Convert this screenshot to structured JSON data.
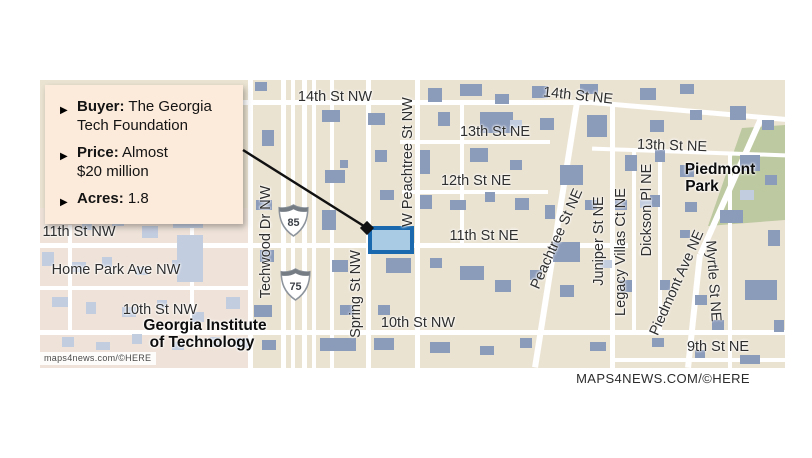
{
  "page": {
    "bg": "#ffffff"
  },
  "callout": {
    "bg": "#fceada",
    "bullet_icon": "▶",
    "items": [
      {
        "label": "Buyer:",
        "lines": [
          "The Georgia",
          "Tech Foundation"
        ]
      },
      {
        "label": "Price:",
        "lines": [
          "Almost",
          "$20 million"
        ]
      },
      {
        "label": "Acres:",
        "lines": [
          "1.8"
        ]
      }
    ]
  },
  "attribution_footer": "MAPS4NEWS.COM/©HERE",
  "map": {
    "colors": {
      "background": "#ebe3d2",
      "campus": "#efe3d9",
      "park": "#bdc9a0",
      "road": "#ffffff",
      "building_dark": "#8b9bba",
      "building_light": "#c2cddf",
      "parcel_fill": "#a9cbe3",
      "parcel_border": "#1a69ae",
      "connector": "#111111"
    },
    "attribution": "maps4news.com/©HERE",
    "shields": [
      {
        "num": "85",
        "x": 238,
        "y": 124
      },
      {
        "num": "75",
        "x": 240,
        "y": 188
      }
    ],
    "parcel": {
      "x": 328,
      "y": 146,
      "w": 46,
      "h": 28
    },
    "connector": {
      "x1": 243,
      "y1": 150,
      "x2": 367,
      "y2": 228
    },
    "roads": [
      {
        "x": 200,
        "y": 20,
        "w": 350,
        "h": 5,
        "r": 0
      },
      {
        "x": 539,
        "y": 28,
        "w": 208,
        "h": 5,
        "r": 5
      },
      {
        "x": 360,
        "y": 60,
        "w": 150,
        "h": 4,
        "r": 0
      },
      {
        "x": 552,
        "y": 70,
        "w": 195,
        "h": 4,
        "r": 2
      },
      {
        "x": 362,
        "y": 110,
        "w": 146,
        "h": 4,
        "r": 0
      },
      {
        "x": 0,
        "y": 163,
        "w": 588,
        "h": 5,
        "r": 0
      },
      {
        "x": 0,
        "y": 206,
        "w": 212,
        "h": 4,
        "r": 0
      },
      {
        "x": 0,
        "y": 250,
        "w": 745,
        "h": 5,
        "r": 0
      },
      {
        "x": 575,
        "y": 278,
        "w": 170,
        "h": 4,
        "r": 0
      },
      {
        "x": 208,
        "y": 0,
        "w": 5,
        "h": 288,
        "r": 0
      },
      {
        "x": 241,
        "y": 0,
        "w": 5,
        "h": 288,
        "r": 0
      },
      {
        "x": 251,
        "y": 0,
        "w": 4,
        "h": 288,
        "r": 0
      },
      {
        "x": 262,
        "y": 0,
        "w": 5,
        "h": 288,
        "r": 0
      },
      {
        "x": 272,
        "y": 0,
        "w": 4,
        "h": 288,
        "r": 0
      },
      {
        "x": 290,
        "y": 0,
        "w": 4,
        "h": 288,
        "r": 0
      },
      {
        "x": 326,
        "y": 0,
        "w": 5,
        "h": 288,
        "r": 0
      },
      {
        "x": 375,
        "y": 0,
        "w": 5,
        "h": 288,
        "r": 0
      },
      {
        "x": 420,
        "y": 20,
        "w": 4,
        "h": 145,
        "r": 0
      },
      {
        "x": 570,
        "y": 22,
        "w": 5,
        "h": 266,
        "r": 0
      },
      {
        "x": 592,
        "y": 70,
        "w": 4,
        "h": 182,
        "r": 0
      },
      {
        "x": 618,
        "y": 70,
        "w": 4,
        "h": 180,
        "r": 0
      },
      {
        "x": 688,
        "y": 72,
        "w": 4,
        "h": 216,
        "r": 0
      },
      {
        "x": 513,
        "y": 21,
        "w": 6,
        "h": 268,
        "r": 9
      },
      {
        "x": 688,
        "y": 31,
        "w": 6,
        "h": 150,
        "r": 24
      },
      {
        "x": 651,
        "y": 174,
        "w": 6,
        "h": 114,
        "r": 6
      },
      {
        "x": 28,
        "y": 145,
        "w": 4,
        "h": 107,
        "r": 0
      },
      {
        "x": 150,
        "y": 125,
        "w": 4,
        "h": 127,
        "r": 0
      }
    ],
    "buildings": [
      [
        215,
        2,
        12,
        9,
        "d"
      ],
      [
        222,
        50,
        12,
        16,
        "d"
      ],
      [
        216,
        120,
        16,
        10,
        "d"
      ],
      [
        220,
        170,
        14,
        12,
        "d"
      ],
      [
        214,
        225,
        18,
        12,
        "d"
      ],
      [
        222,
        260,
        14,
        10,
        "d"
      ],
      [
        282,
        30,
        18,
        12,
        "d"
      ],
      [
        285,
        90,
        20,
        13,
        "d"
      ],
      [
        300,
        80,
        8,
        8,
        "d"
      ],
      [
        282,
        130,
        14,
        20,
        "d"
      ],
      [
        292,
        180,
        16,
        12,
        "d"
      ],
      [
        300,
        225,
        14,
        10,
        "d"
      ],
      [
        280,
        258,
        36,
        13,
        "d"
      ],
      [
        328,
        33,
        17,
        12,
        "d"
      ],
      [
        335,
        70,
        12,
        12,
        "d"
      ],
      [
        340,
        110,
        14,
        10,
        "d"
      ],
      [
        346,
        178,
        25,
        15,
        "d"
      ],
      [
        338,
        225,
        12,
        10,
        "d"
      ],
      [
        334,
        258,
        20,
        12,
        "d"
      ],
      [
        388,
        8,
        14,
        14,
        "d"
      ],
      [
        420,
        4,
        22,
        12,
        "d"
      ],
      [
        455,
        14,
        14,
        10,
        "d"
      ],
      [
        492,
        6,
        16,
        12,
        "d"
      ],
      [
        440,
        32,
        33,
        21,
        "d"
      ],
      [
        398,
        32,
        12,
        14,
        "d"
      ],
      [
        500,
        38,
        14,
        12,
        "d"
      ],
      [
        380,
        70,
        10,
        24,
        "d"
      ],
      [
        430,
        68,
        18,
        14,
        "d"
      ],
      [
        470,
        80,
        12,
        10,
        "d"
      ],
      [
        380,
        115,
        12,
        14,
        "d"
      ],
      [
        410,
        120,
        16,
        10,
        "d"
      ],
      [
        445,
        112,
        10,
        10,
        "d"
      ],
      [
        475,
        118,
        14,
        12,
        "d"
      ],
      [
        505,
        125,
        10,
        14,
        "d"
      ],
      [
        390,
        178,
        12,
        10,
        "d"
      ],
      [
        420,
        186,
        24,
        14,
        "d"
      ],
      [
        455,
        200,
        16,
        12,
        "d"
      ],
      [
        490,
        190,
        12,
        10,
        "d"
      ],
      [
        390,
        262,
        20,
        11,
        "d"
      ],
      [
        440,
        266,
        14,
        9,
        "d"
      ],
      [
        480,
        258,
        12,
        10,
        "d"
      ],
      [
        540,
        4,
        18,
        10,
        "d"
      ],
      [
        547,
        35,
        20,
        22,
        "d"
      ],
      [
        520,
        85,
        23,
        20,
        "d"
      ],
      [
        513,
        162,
        27,
        20,
        "d"
      ],
      [
        520,
        205,
        14,
        12,
        "d"
      ],
      [
        545,
        120,
        12,
        10,
        "d"
      ],
      [
        550,
        262,
        16,
        9,
        "d"
      ],
      [
        600,
        8,
        16,
        12,
        "d"
      ],
      [
        640,
        4,
        14,
        10,
        "d"
      ],
      [
        610,
        40,
        14,
        12,
        "d"
      ],
      [
        650,
        30,
        12,
        10,
        "d"
      ],
      [
        585,
        75,
        12,
        16,
        "d"
      ],
      [
        615,
        70,
        10,
        12,
        "d"
      ],
      [
        640,
        85,
        14,
        12,
        "d"
      ],
      [
        575,
        120,
        12,
        10,
        "d"
      ],
      [
        610,
        115,
        10,
        12,
        "d"
      ],
      [
        645,
        122,
        12,
        10,
        "d"
      ],
      [
        640,
        150,
        10,
        8,
        "d"
      ],
      [
        580,
        200,
        12,
        12,
        "d"
      ],
      [
        620,
        200,
        10,
        10,
        "d"
      ],
      [
        655,
        215,
        12,
        10,
        "d"
      ],
      [
        612,
        258,
        12,
        9,
        "d"
      ],
      [
        655,
        270,
        10,
        8,
        "d"
      ],
      [
        690,
        26,
        16,
        14,
        "d"
      ],
      [
        722,
        40,
        12,
        10,
        "d"
      ],
      [
        700,
        75,
        20,
        16,
        "d"
      ],
      [
        725,
        95,
        12,
        10,
        "d"
      ],
      [
        680,
        130,
        23,
        13,
        "d"
      ],
      [
        705,
        200,
        32,
        20,
        "d"
      ],
      [
        672,
        240,
        12,
        10,
        "d"
      ],
      [
        700,
        275,
        20,
        9,
        "d"
      ],
      [
        728,
        150,
        12,
        16,
        "d"
      ],
      [
        734,
        240,
        10,
        12,
        "d"
      ],
      [
        10,
        132,
        14,
        10,
        "l"
      ],
      [
        42,
        142,
        10,
        8,
        "l"
      ],
      [
        72,
        136,
        12,
        10,
        "l"
      ],
      [
        102,
        146,
        16,
        12,
        "l"
      ],
      [
        142,
        140,
        10,
        8,
        "l"
      ],
      [
        2,
        172,
        12,
        14,
        "l"
      ],
      [
        32,
        182,
        14,
        10,
        "l"
      ],
      [
        62,
        177,
        10,
        10,
        "l"
      ],
      [
        96,
        187,
        12,
        8,
        "l"
      ],
      [
        132,
        180,
        14,
        12,
        "l"
      ],
      [
        133,
        135,
        30,
        13,
        "l"
      ],
      [
        137,
        155,
        26,
        47,
        "l"
      ],
      [
        12,
        217,
        16,
        10,
        "l"
      ],
      [
        46,
        222,
        10,
        12,
        "l"
      ],
      [
        82,
        227,
        14,
        10,
        "l"
      ],
      [
        117,
        220,
        10,
        8,
        "l"
      ],
      [
        152,
        232,
        12,
        10,
        "l"
      ],
      [
        186,
        217,
        14,
        12,
        "l"
      ],
      [
        22,
        257,
        12,
        10,
        "l"
      ],
      [
        56,
        262,
        14,
        8,
        "l"
      ],
      [
        92,
        254,
        10,
        10,
        "l"
      ],
      [
        132,
        262,
        12,
        8,
        "l"
      ],
      [
        170,
        257,
        10,
        10,
        "l"
      ],
      [
        196,
        258,
        12,
        10,
        "l"
      ],
      [
        470,
        40,
        12,
        8,
        "l"
      ],
      [
        600,
        120,
        12,
        8,
        "l"
      ],
      [
        700,
        110,
        14,
        10,
        "l"
      ],
      [
        560,
        180,
        12,
        8,
        "l"
      ]
    ],
    "labels": [
      {
        "t": "14th St NW",
        "x": 295,
        "y": 17,
        "r": 0,
        "b": 0
      },
      {
        "t": "14th St NE",
        "x": 538,
        "y": 16,
        "r": 6,
        "b": 0
      },
      {
        "t": "13th St NE",
        "x": 455,
        "y": 52,
        "r": 0,
        "b": 0
      },
      {
        "t": "13th St NE",
        "x": 632,
        "y": 66,
        "r": 2,
        "b": 0
      },
      {
        "t": "12th St NE",
        "x": 436,
        "y": 101,
        "r": 0,
        "b": 0
      },
      {
        "t": "11th St NE",
        "x": 444,
        "y": 156,
        "r": 0,
        "b": 0
      },
      {
        "t": "11th St NW",
        "x": 39,
        "y": 152,
        "r": 0,
        "b": 0
      },
      {
        "t": "Home Park Ave NW",
        "x": 76,
        "y": 190,
        "r": 0,
        "b": 0
      },
      {
        "t": "10th St NW",
        "x": 120,
        "y": 230,
        "r": 0,
        "b": 0
      },
      {
        "t": "10th St NW",
        "x": 378,
        "y": 243,
        "r": 0,
        "b": 0
      },
      {
        "t": "9th St NE",
        "x": 678,
        "y": 267,
        "r": 0,
        "b": 0
      },
      {
        "t": "Georgia Institute",
        "x": 165,
        "y": 246,
        "r": 0,
        "b": 1
      },
      {
        "t": "of Technology",
        "x": 162,
        "y": 263,
        "r": 0,
        "b": 1
      },
      {
        "t": "Piedmont",
        "x": 680,
        "y": 90,
        "r": 0,
        "b": 1
      },
      {
        "t": "Park",
        "x": 662,
        "y": 107,
        "r": 0,
        "b": 1
      },
      {
        "t": "Techwood Dr NW",
        "x": 226,
        "y": 162,
        "r": -90,
        "b": 0
      },
      {
        "t": "Spring St NW",
        "x": 316,
        "y": 214,
        "r": -90,
        "b": 0
      },
      {
        "t": "W Peachtree St NW",
        "x": 368,
        "y": 82,
        "r": -90,
        "b": 0
      },
      {
        "t": "Peachtree St NE",
        "x": 517,
        "y": 159,
        "r": -66,
        "b": 0
      },
      {
        "t": "Juniper St NE",
        "x": 559,
        "y": 161,
        "r": -90,
        "b": 0
      },
      {
        "t": "Legacy Villas Ct NE",
        "x": 581,
        "y": 172,
        "r": -90,
        "b": 0
      },
      {
        "t": "Dickson Pl NE",
        "x": 607,
        "y": 130,
        "r": -90,
        "b": 0
      },
      {
        "t": "Piedmont Ave NE",
        "x": 637,
        "y": 203,
        "r": -66,
        "b": 0
      },
      {
        "t": "Myrtle St NE",
        "x": 673,
        "y": 201,
        "r": 86,
        "b": 0
      }
    ]
  }
}
